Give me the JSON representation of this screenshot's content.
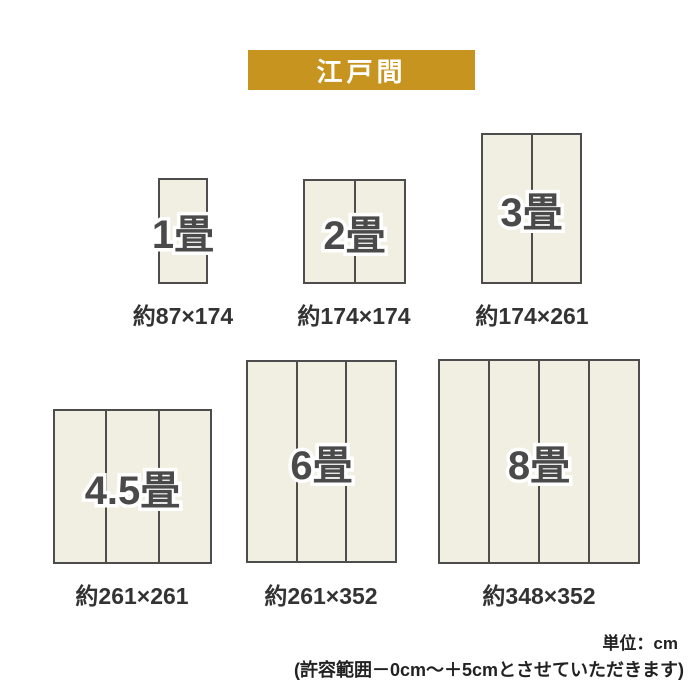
{
  "title_badge": {
    "label": "江戸間"
  },
  "sizes": [
    {
      "name": "1畳",
      "dimensions": "約87×174",
      "panels": 1
    },
    {
      "name": "2畳",
      "dimensions": "約174×174",
      "panels": 2
    },
    {
      "name": "3畳",
      "dimensions": "約174×261",
      "panels": 2
    },
    {
      "name": "4.5畳",
      "dimensions": "約261×261",
      "panels": 3
    },
    {
      "name": "6畳",
      "dimensions": "約261×352",
      "panels": 3
    },
    {
      "name": "8畳",
      "dimensions": "約348×352",
      "panels": 4
    }
  ],
  "footer": {
    "unit": "単位：cm",
    "tolerance": "(許容範囲－0cm～＋5cmとさせていただきます)"
  },
  "colors": {
    "badge_bg": "#C79420",
    "mat_fill": "#F1EFE2",
    "mat_border": "#4D4D4D",
    "label_text": "#333333"
  }
}
